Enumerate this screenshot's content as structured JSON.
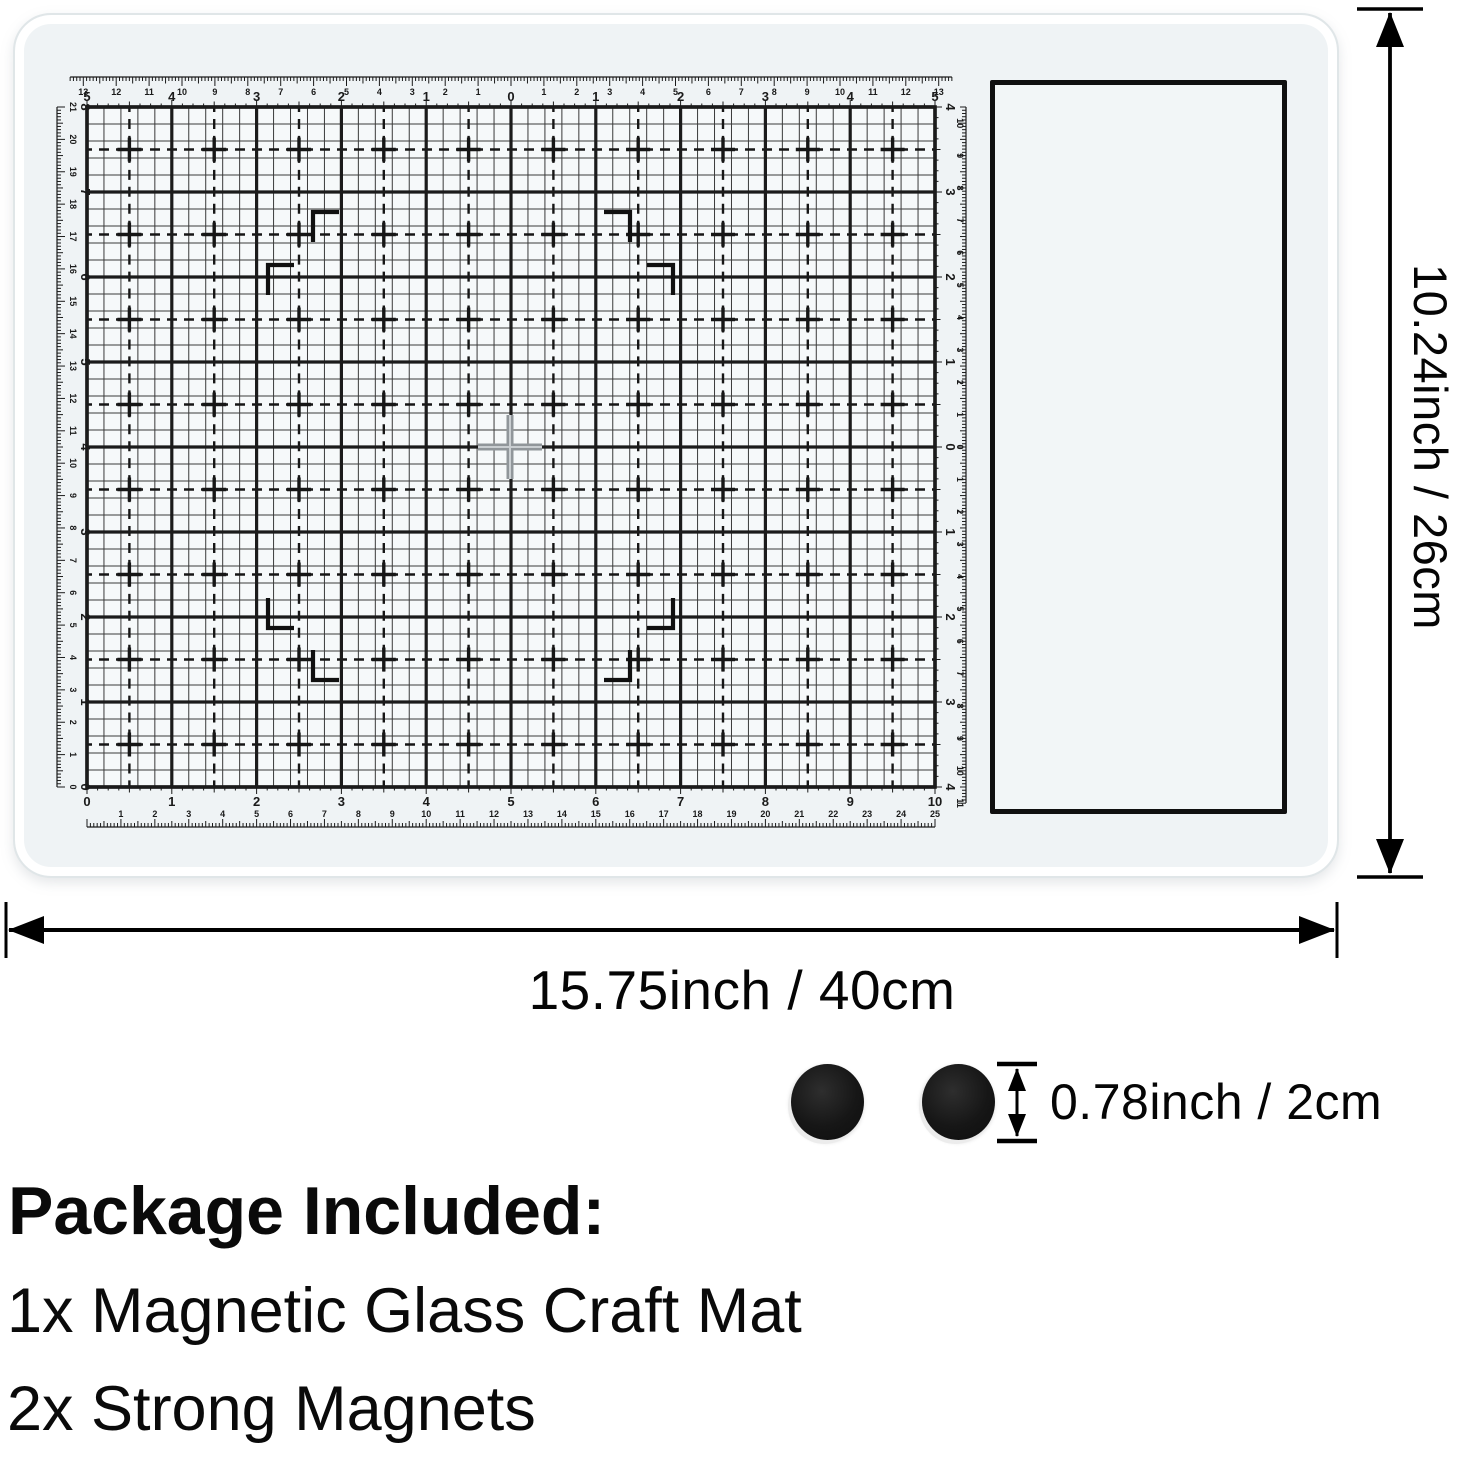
{
  "dimensions": {
    "height_label": "10.24inch / 26cm",
    "width_label": "15.75inch / 40cm",
    "magnet_label": "0.78inch / 2cm"
  },
  "package": {
    "title": "Package Included:",
    "items": [
      "1x Magnetic Glass Craft Mat",
      "2x Strong Magnets"
    ]
  },
  "colors": {
    "line": "#0d0d0d",
    "grid_heavy": "#1b1b1b",
    "grid_thin": "#3a3a3a",
    "grid_dash": "#161616",
    "ruler": "#1a1a1a",
    "cross_gray": "#90969a",
    "cross_light": "#c9ced1",
    "mat_fill": "#eff3f5",
    "grid_fill": "#f6f9fa",
    "magnet": "#141414"
  },
  "mat": {
    "grid": {
      "x": 87,
      "y": 107,
      "w": 848,
      "h": 680,
      "inches_w": 10,
      "inches_h": 8
    },
    "rulers": {
      "top_cm": {
        "labels": [
          "13",
          "12",
          "11",
          "10",
          "9",
          "8",
          "7",
          "6",
          "5",
          "4",
          "3",
          "2",
          "1",
          "",
          "1",
          "2",
          "3",
          "4",
          "5",
          "6",
          "7",
          "8",
          "9",
          "10",
          "11",
          "12",
          "13"
        ]
      },
      "top_inch": {
        "labels": [
          "5",
          "4",
          "3",
          "2",
          "1",
          "0",
          "1",
          "2",
          "3",
          "4",
          "5"
        ]
      },
      "bottom_inch": {
        "labels": [
          "0",
          "1",
          "2",
          "3",
          "4",
          "5",
          "6",
          "7",
          "8",
          "9",
          "10"
        ]
      },
      "bottom_cm": {
        "labels": [
          "1",
          "2",
          "3",
          "4",
          "5",
          "6",
          "7",
          "8",
          "9",
          "10",
          "11",
          "12",
          "13",
          "14",
          "15",
          "16",
          "17",
          "18",
          "19",
          "20",
          "21",
          "22",
          "23",
          "24",
          "25"
        ]
      },
      "left_cm": {
        "labels": [
          "21",
          "20",
          "19",
          "18",
          "17",
          "16",
          "15",
          "14",
          "13",
          "12",
          "11",
          "10",
          "9",
          "8",
          "7",
          "6",
          "5",
          "4",
          "3",
          "2",
          "1",
          "0"
        ]
      },
      "left_inch": {
        "labels": [
          "8",
          "7",
          "6",
          "5",
          "4",
          "3",
          "2",
          "1",
          "0"
        ]
      },
      "right_inch": {
        "labels": [
          "4",
          "3",
          "2",
          "1",
          "0",
          "1",
          "2",
          "3",
          "4"
        ]
      },
      "right_cm": {
        "labels": [
          "10",
          "9",
          "8",
          "7",
          "6",
          "5",
          "4",
          "3",
          "2",
          "1",
          "0",
          "1",
          "2",
          "3",
          "4",
          "5",
          "6",
          "7",
          "8",
          "9",
          "10",
          "11"
        ]
      }
    },
    "registration_marks": [
      {
        "corner": "tl",
        "x": 313,
        "y": 212
      },
      {
        "corner": "tr",
        "x": 630,
        "y": 212
      },
      {
        "corner": "tl",
        "x": 268,
        "y": 265
      },
      {
        "corner": "tr",
        "x": 673,
        "y": 265
      },
      {
        "corner": "bl",
        "x": 268,
        "y": 628
      },
      {
        "corner": "br",
        "x": 673,
        "y": 628
      },
      {
        "corner": "bl",
        "x": 313,
        "y": 680
      },
      {
        "corner": "br",
        "x": 630,
        "y": 680
      }
    ],
    "center_cross": {
      "x": 510,
      "y": 447
    }
  },
  "arrows": {
    "vertical": {
      "x": 1390,
      "y1": 9,
      "y2": 877,
      "cap_half": 33
    },
    "horizontal": {
      "y": 930,
      "x1": 6,
      "x2": 1337,
      "cap_half": 28
    },
    "magnet": {
      "x": 1017,
      "y1": 1064,
      "y2": 1141,
      "cap_half": 20
    }
  }
}
